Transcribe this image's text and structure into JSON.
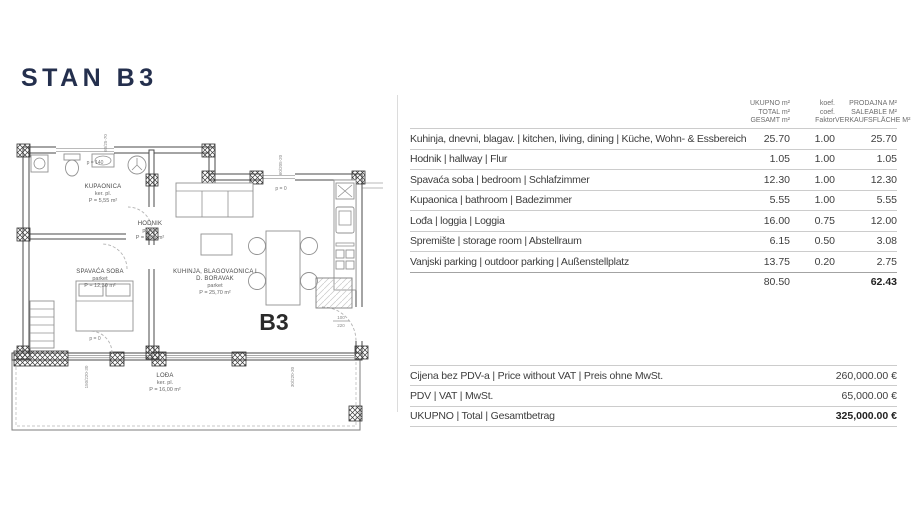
{
  "title": "STAN B3",
  "area_table": {
    "headers": {
      "total": [
        "UKUPNO m²",
        "TOTAL m²",
        "GESAMT m²"
      ],
      "coef": [
        "koef.",
        "coef.",
        "Faktor"
      ],
      "saleable": [
        "PRODAJNA M²",
        "SALEABLE M²",
        "VERKAUFSFLÄCHE M²"
      ]
    },
    "rows": [
      {
        "name": "Kuhinja, dnevni, blagav. | kitchen, living, dining | Küche, Wohn- & Essbereich",
        "total": "25.70",
        "coef": "1.00",
        "saleable": "25.70"
      },
      {
        "name": "Hodnik | hallway | Flur",
        "total": "1.05",
        "coef": "1.00",
        "saleable": "1.05"
      },
      {
        "name": "Spavaća soba | bedroom | Schlafzimmer",
        "total": "12.30",
        "coef": "1.00",
        "saleable": "12.30"
      },
      {
        "name": "Kupaonica | bathroom | Badezimmer",
        "total": "5.55",
        "coef": "1.00",
        "saleable": "5.55"
      },
      {
        "name": "Lođa | loggia | Loggia",
        "total": "16.00",
        "coef": "0.75",
        "saleable": "12.00"
      },
      {
        "name": "Spremište | storage room | Abstellraum",
        "total": "6.15",
        "coef": "0.50",
        "saleable": "3.08"
      },
      {
        "name": "Vanjski parking | outdoor parking | Außenstellplatz",
        "total": "13.75",
        "coef": "0.20",
        "saleable": "2.75"
      }
    ],
    "totals": {
      "total": "80.50",
      "saleable": "62.43"
    }
  },
  "price_table": {
    "rows": [
      {
        "label": "Cijena bez PDV-a | Price without VAT | Preis ohne MwSt.",
        "value": "260,000.00 €"
      },
      {
        "label": "PDV | VAT | MwSt.",
        "value": "65,000.00 €"
      },
      {
        "label": "UKUPNO | Total | Gesamtbetrag",
        "value": "325,000.00 €"
      }
    ]
  },
  "floor_plan": {
    "unit_label": "B3",
    "rooms": [
      {
        "name": "KUPAONICA",
        "floor": "ker. pl.",
        "area": "P = 5,55 m²"
      },
      {
        "name": "HODNIK",
        "floor": "parket",
        "area": "P = 1,05 m²"
      },
      {
        "name": "SPAVAĆA SOBA",
        "floor": "parket",
        "area": "P = 12,30 m²"
      },
      {
        "name": "KUHINJA, BLAGOVAONICA I",
        "name2": "D. BORAVAK",
        "floor": "parket",
        "area": "P = 25,70 m²"
      },
      {
        "name": "LOĐA",
        "floor": "ker. pl.",
        "area": "P = 16,00 m²"
      }
    ],
    "annotations": {
      "window_parapet": "p = 140",
      "door_level_1": "p = 0",
      "door_level_2": "p = 0",
      "entry_dim_w": "100",
      "entry_dim_h": "220",
      "dim_top": "60/25-70",
      "dim_right_top": "60/205-20",
      "dim_bottom_left": "150/220-30",
      "dim_bottom_right": "30/220-30"
    }
  }
}
